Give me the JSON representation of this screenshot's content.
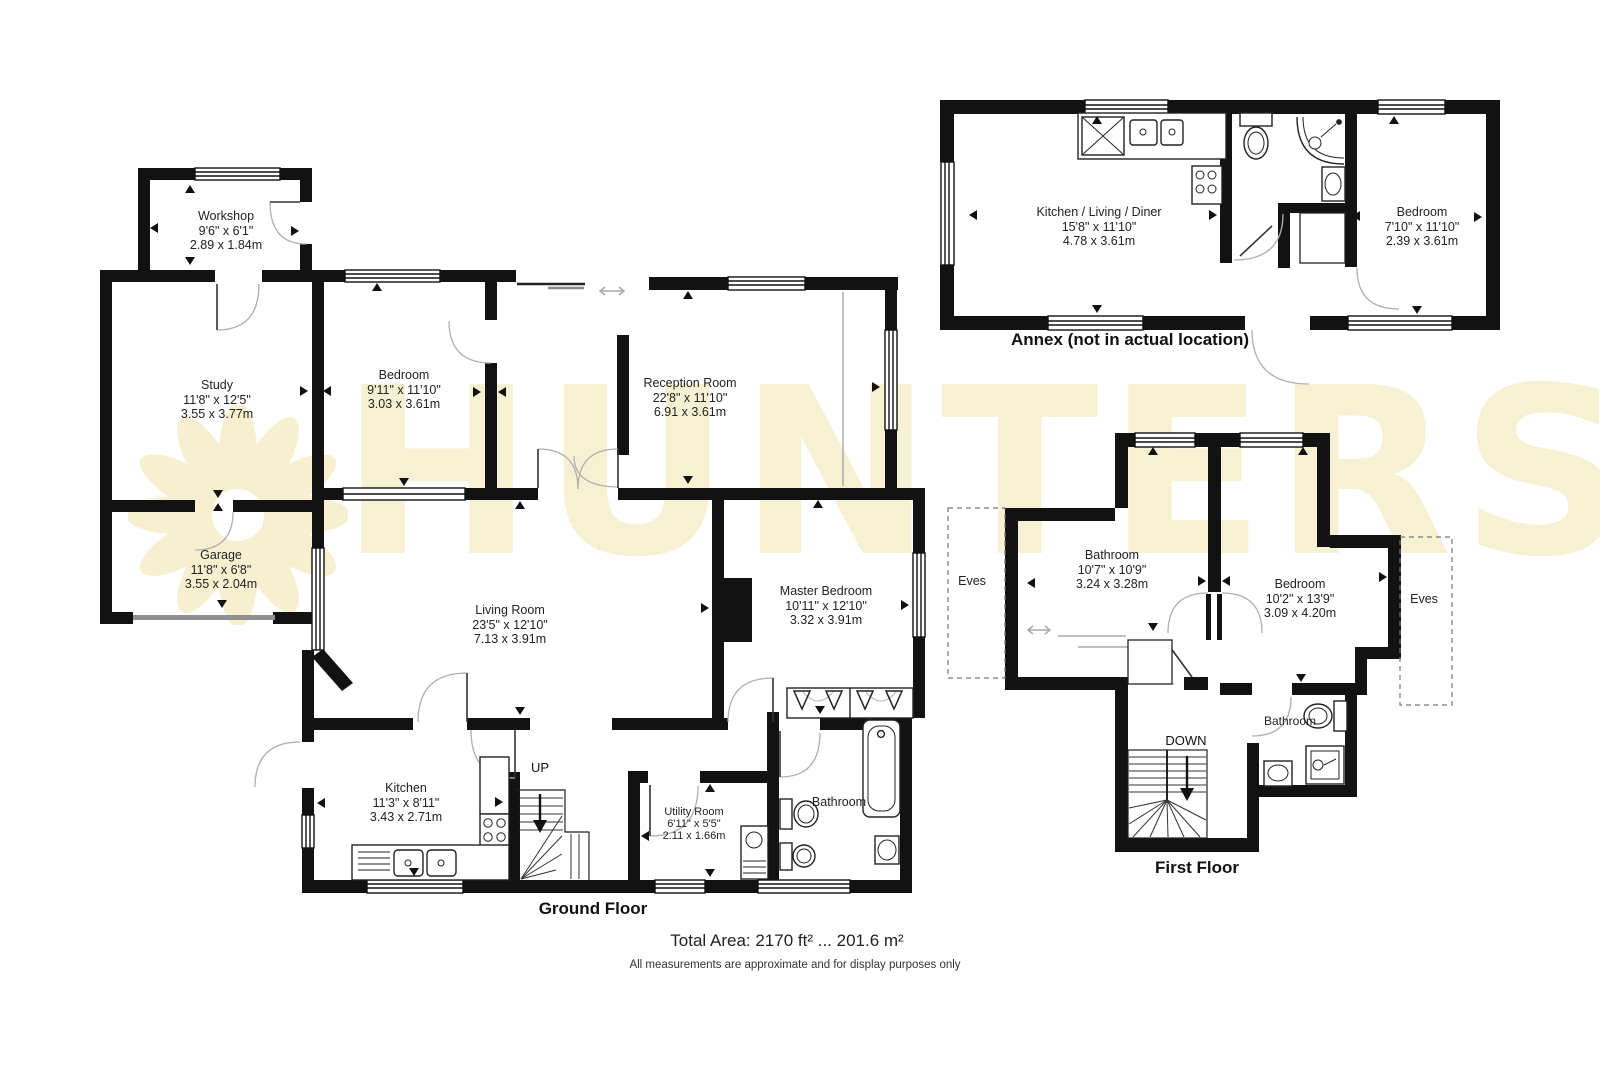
{
  "watermark": {
    "text": "HUNTERS"
  },
  "ground_floor": {
    "title": "Ground Floor",
    "stairs": {
      "direction_label": "UP"
    },
    "rooms": {
      "workshop": {
        "name": "Workshop",
        "imperial": "9'6\" x 6'1\"",
        "metric": "2.89 x 1.84m"
      },
      "study": {
        "name": "Study",
        "imperial": "11'8\" x 12'5\"",
        "metric": "3.55 x 3.77m"
      },
      "garage": {
        "name": "Garage",
        "imperial": "11'8\" x 6'8\"",
        "metric": "3.55 x 2.04m"
      },
      "bedroom": {
        "name": "Bedroom",
        "imperial": "9'11\" x 11'10\"",
        "metric": "3.03 x 3.61m"
      },
      "reception": {
        "name": "Reception Room",
        "imperial": "22'8\" x 11'10\"",
        "metric": "6.91 x 3.61m"
      },
      "living": {
        "name": "Living Room",
        "imperial": "23'5\" x 12'10\"",
        "metric": "7.13 x 3.91m"
      },
      "master": {
        "name": "Master Bedroom",
        "imperial": "10'11\" x 12'10\"",
        "metric": "3.32 x 3.91m"
      },
      "kitchen": {
        "name": "Kitchen",
        "imperial": "11'3\" x 8'11\"",
        "metric": "3.43 x 2.71m"
      },
      "utility": {
        "name": "Utility Room",
        "imperial": "6'11\" x 5'5\"",
        "metric": "2.11 x 1.66m"
      },
      "bathroom": {
        "name": "Bathroom"
      }
    }
  },
  "annex": {
    "title": "Annex (not in actual location)",
    "rooms": {
      "kitchen_living_diner": {
        "name": "Kitchen / Living / Diner",
        "imperial": "15'8\" x 11'10\"",
        "metric": "4.78 x 3.61m"
      },
      "bedroom": {
        "name": "Bedroom",
        "imperial": "7'10\" x 11'10\"",
        "metric": "2.39 x 3.61m"
      }
    }
  },
  "first_floor": {
    "title": "First Floor",
    "stairs": {
      "direction_label": "DOWN"
    },
    "rooms": {
      "bathroom": {
        "name": "Bathroom",
        "imperial": "10'7\" x 10'9\"",
        "metric": "3.24 x 3.28m"
      },
      "bedroom": {
        "name": "Bedroom",
        "imperial": "10'2\" x 13'9\"",
        "metric": "3.09 x 4.20m"
      },
      "bathroom_small": {
        "name": "Bathroom"
      },
      "eves_left": {
        "name": "Eves"
      },
      "eves_right": {
        "name": "Eves"
      }
    }
  },
  "footer": {
    "total_area": "Total Area: 2170 ft² ... 201.6 m²",
    "disclaimer": "All measurements are approximate and for display purposes only"
  }
}
